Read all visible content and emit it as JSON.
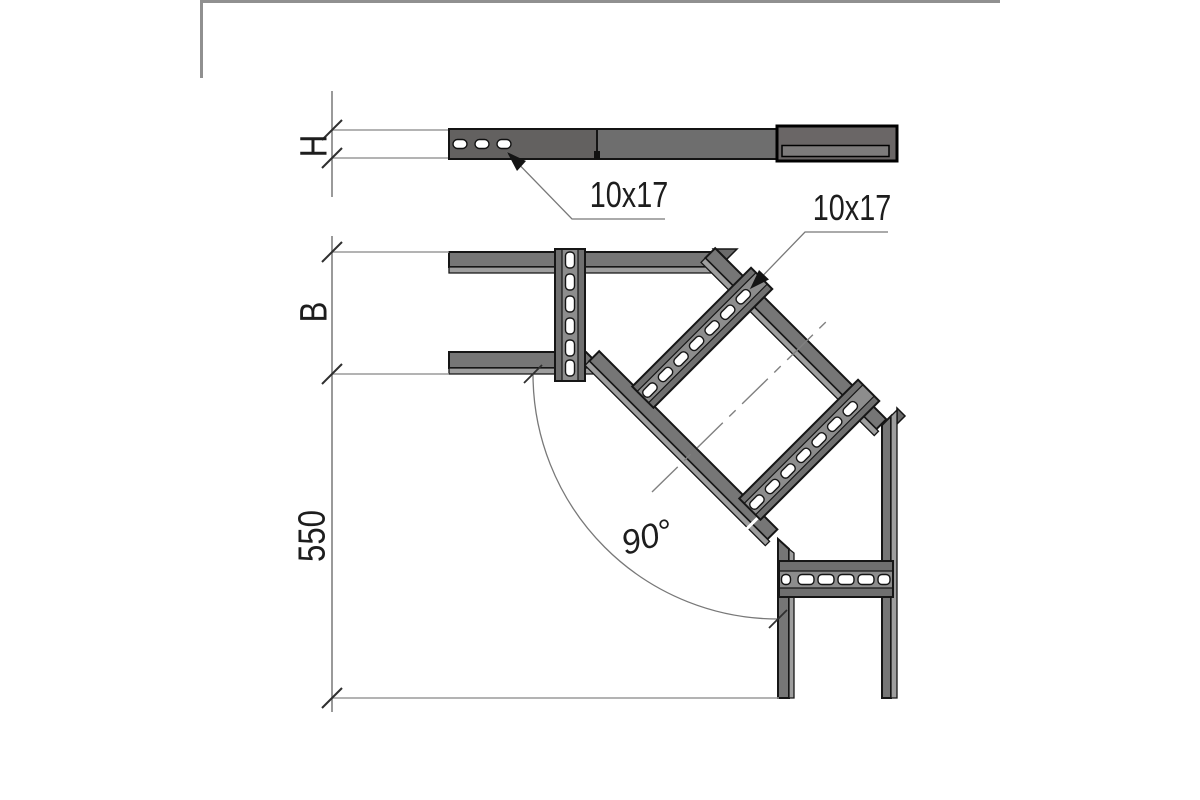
{
  "drawing": {
    "views": {
      "side_view": "cable-ladder profile (side elevation)",
      "plan_view": "cable-ladder 90-degree horizontal bend (plan)"
    },
    "labels": {
      "height_dim": "H",
      "width_dim": "B",
      "length_dim": "550",
      "angle_dim": "90°",
      "slot_side": "10x17",
      "slot_plan": "10x17"
    },
    "colors": {
      "metal": "#767676",
      "metal_dark_flange": "#6f6f6f",
      "metal_web": "#8d8d8d",
      "metal_light_edge": "#9e9e9e",
      "profile_bar": "#6a6666",
      "outline": "#161616",
      "slot_fill": "#ffffff",
      "dimension_line": "#787878",
      "extension_line": "#9a9a9a",
      "tick": "#2f2f2f",
      "frame_border": "#909090",
      "background": "#ffffff"
    }
  }
}
